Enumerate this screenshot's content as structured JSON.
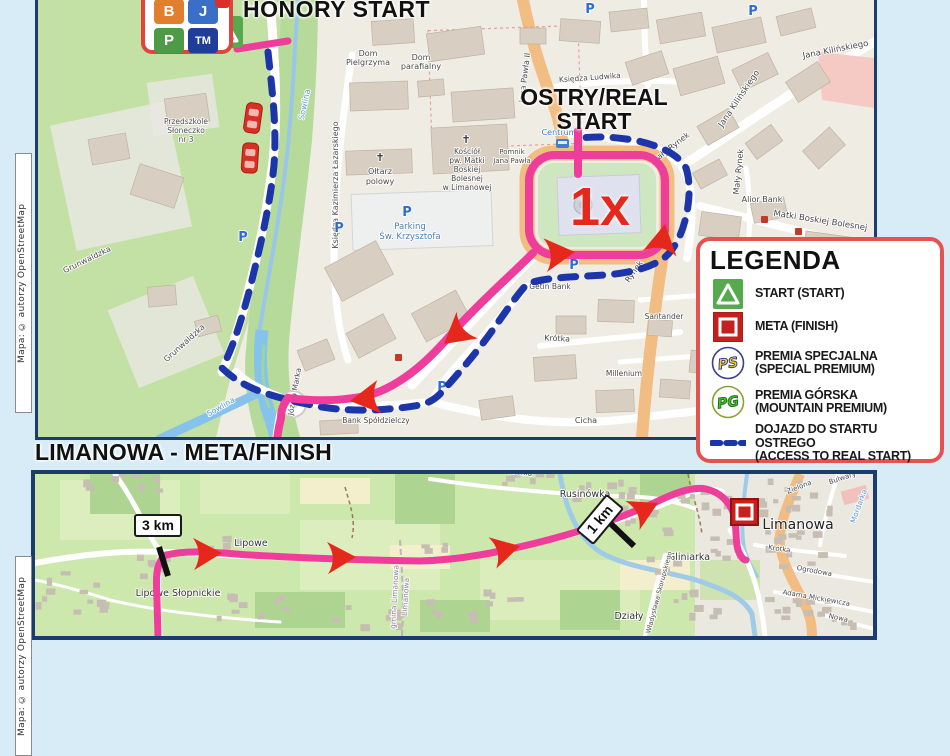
{
  "attribution": {
    "text": "Mapa: © autorzy OpenStreetMap"
  },
  "badge_box": {
    "tiles": [
      {
        "label": "B",
        "color": "#e0802f"
      },
      {
        "label": "J",
        "color": "#3a6fc8"
      },
      {
        "label": "P",
        "color": "#4e9a47"
      },
      {
        "label": "TM",
        "color": "#1f3d99"
      }
    ]
  },
  "top_map": {
    "honory_title": "HONORY START",
    "ostry_line1": "OSTRY/REAL",
    "ostry_line2": "START",
    "lap_label": "1x",
    "labels": [
      {
        "t": "Dom",
        "x": 368,
        "y": 56,
        "s": 8
      },
      {
        "t": "Pielgrzyma",
        "x": 368,
        "y": 65,
        "s": 8
      },
      {
        "t": "Dom",
        "x": 421,
        "y": 60,
        "s": 8
      },
      {
        "t": "parafialny",
        "x": 421,
        "y": 69,
        "s": 8
      },
      {
        "t": "✝",
        "x": 466,
        "y": 143,
        "s": 11,
        "c": "#333"
      },
      {
        "t": "Kościół",
        "x": 467,
        "y": 154,
        "s": 7.5
      },
      {
        "t": "pw. Matki",
        "x": 467,
        "y": 163,
        "s": 7.5
      },
      {
        "t": "Boskiej",
        "x": 467,
        "y": 172,
        "s": 7.5
      },
      {
        "t": "Bolesnej",
        "x": 467,
        "y": 181,
        "s": 7.5
      },
      {
        "t": "w Limanowej",
        "x": 467,
        "y": 190,
        "s": 7.5
      },
      {
        "t": "✝",
        "x": 380,
        "y": 161,
        "s": 11,
        "c": "#333"
      },
      {
        "t": "Ołtarz",
        "x": 380,
        "y": 174,
        "s": 8
      },
      {
        "t": "polowy",
        "x": 380,
        "y": 184,
        "s": 8
      },
      {
        "t": "P",
        "x": 407,
        "y": 216,
        "s": 13,
        "c": "#2e6ccf",
        "w": 700
      },
      {
        "t": "Parking",
        "x": 410,
        "y": 229,
        "s": 8.5,
        "c": "#4a7fb5"
      },
      {
        "t": "Św. Krzysztofa",
        "x": 410,
        "y": 239,
        "s": 8.5,
        "c": "#4a7fb5"
      },
      {
        "t": "Przedszkole",
        "x": 186,
        "y": 124,
        "s": 7.5
      },
      {
        "t": "Słoneczko",
        "x": 186,
        "y": 133,
        "s": 7.5
      },
      {
        "t": "nr 3",
        "x": 186,
        "y": 142,
        "s": 7.5
      },
      {
        "t": "Grunwaldzka",
        "x": 88,
        "y": 262,
        "s": 8,
        "r": -26
      },
      {
        "t": "Grunwaldzka",
        "x": 186,
        "y": 345,
        "s": 8,
        "r": -42
      },
      {
        "t": "Księdza Kazimierza Łazarskiego",
        "x": 338,
        "y": 185,
        "s": 8,
        "r": -90
      },
      {
        "t": "Jana Pawła II",
        "x": 527,
        "y": 78,
        "s": 8,
        "r": -83
      },
      {
        "t": "Księdza Ludwika",
        "x": 590,
        "y": 80,
        "s": 7.5,
        "r": -4
      },
      {
        "t": "Mały Rynek",
        "x": 672,
        "y": 150,
        "s": 8,
        "r": -38
      },
      {
        "t": "Mały Rynek",
        "x": 741,
        "y": 172,
        "s": 8,
        "r": -84
      },
      {
        "t": "Jana Kilińskiego",
        "x": 836,
        "y": 52,
        "s": 8.5,
        "r": -11
      },
      {
        "t": "Jana Kilińskiego",
        "x": 741,
        "y": 100,
        "s": 8.5,
        "r": -56
      },
      {
        "t": "Alior Bank",
        "x": 762,
        "y": 202,
        "s": 8
      },
      {
        "t": "Matki Boskiej Bolesnej",
        "x": 820,
        "y": 223,
        "s": 8.5,
        "r": 9
      },
      {
        "t": "Rynek",
        "x": 636,
        "y": 273,
        "s": 8,
        "r": -55
      },
      {
        "t": "Krótka",
        "x": 557,
        "y": 341,
        "s": 8,
        "r": 3
      },
      {
        "t": "Cicha",
        "x": 586,
        "y": 423,
        "s": 8
      },
      {
        "t": "Santander",
        "x": 664,
        "y": 319,
        "s": 7.5
      },
      {
        "t": "Millenium",
        "x": 624,
        "y": 376,
        "s": 7.5
      },
      {
        "t": "Getin Bank",
        "x": 550,
        "y": 289,
        "s": 7.5
      },
      {
        "t": "Bank Spółdzielczy",
        "x": 376,
        "y": 423,
        "s": 7.5
      },
      {
        "t": "Pomnik",
        "x": 512,
        "y": 154,
        "s": 7
      },
      {
        "t": "Jana Pawła",
        "x": 512,
        "y": 163,
        "s": 7
      },
      {
        "t": "Centrum",
        "x": 559,
        "y": 135,
        "s": 8,
        "c": "#3b79c9"
      },
      {
        "t": "Sowlina",
        "x": 307,
        "y": 105,
        "s": 8,
        "c": "#5a9bd0",
        "r": -78
      },
      {
        "t": "Sowlina",
        "x": 222,
        "y": 409,
        "s": 8,
        "c": "#5a9bd0",
        "r": -30
      },
      {
        "t": "Józefa Marka",
        "x": 297,
        "y": 392,
        "s": 7.5,
        "r": -80
      },
      {
        "t": "P",
        "x": 590,
        "y": 13,
        "s": 13,
        "c": "#2e6ccf",
        "w": 700
      },
      {
        "t": "P",
        "x": 753,
        "y": 15,
        "s": 13,
        "c": "#2e6ccf",
        "w": 700
      },
      {
        "t": "P",
        "x": 243,
        "y": 241,
        "s": 13,
        "c": "#2e6ccf",
        "w": 700
      },
      {
        "t": "P",
        "x": 339,
        "y": 232,
        "s": 13,
        "c": "#2e6ccf",
        "w": 700
      },
      {
        "t": "P",
        "x": 574,
        "y": 269,
        "s": 13,
        "c": "#2e6ccf",
        "w": 700
      },
      {
        "t": "P",
        "x": 442,
        "y": 391,
        "s": 13,
        "c": "#2e6ccf",
        "w": 700
      }
    ]
  },
  "legend": {
    "title": "LEGENDA",
    "items": [
      {
        "icon": "start-icon",
        "label1": "START (START)",
        "label2": ""
      },
      {
        "icon": "meta-icon",
        "label1": "META (FINISH)",
        "label2": ""
      },
      {
        "icon": "ps-icon",
        "badge": "PS",
        "label1": "PREMIA SPECJALNA",
        "label2": "(SPECIAL PREMIUM)"
      },
      {
        "icon": "pg-icon",
        "badge": "PG",
        "label1": "PREMIA GÓRSKA",
        "label2": "(MOUNTAIN PREMIUM)"
      },
      {
        "icon": "dash-icon",
        "label1": "DOJAZD DO STARTU OSTREGO",
        "label2": "(ACCESS TO REAL START)"
      }
    ]
  },
  "bottom_map": {
    "header": "LIMANOWA - META/FINISH",
    "km3": "3 km",
    "km1": "1 km",
    "labels": [
      {
        "t": "Rusinówka",
        "x": 585,
        "y": 497,
        "s": 9.5,
        "c": "#333"
      },
      {
        "t": "Lipowe",
        "x": 251,
        "y": 546,
        "s": 9.5,
        "c": "#333"
      },
      {
        "t": "Lipowe Słopnickie",
        "x": 178,
        "y": 596,
        "s": 9.5,
        "c": "#333"
      },
      {
        "t": "Gliniarka",
        "x": 689,
        "y": 560,
        "s": 9.5,
        "c": "#333"
      },
      {
        "t": "Działy",
        "x": 629,
        "y": 619,
        "s": 9.5,
        "c": "#333"
      },
      {
        "t": "Limanowa",
        "x": 798,
        "y": 529,
        "s": 14,
        "c": "#222"
      },
      {
        "t": "Jana Biedronia",
        "x": 505,
        "y": 473,
        "s": 7.5,
        "r": 6
      },
      {
        "t": "Krótka",
        "x": 779,
        "y": 551,
        "s": 7,
        "r": 8
      },
      {
        "t": "Ogrodowa",
        "x": 814,
        "y": 573,
        "s": 7,
        "r": 10
      },
      {
        "t": "Adama Mickiewicza",
        "x": 816,
        "y": 600,
        "s": 7,
        "r": 10
      },
      {
        "t": "Nowa",
        "x": 838,
        "y": 620,
        "s": 7,
        "r": 12
      },
      {
        "t": "Władysława Skorupskiego",
        "x": 661,
        "y": 593,
        "s": 6.5,
        "r": -75
      },
      {
        "t": "Zielona",
        "x": 800,
        "y": 489,
        "s": 7,
        "r": -22
      },
      {
        "t": "Bulwary",
        "x": 843,
        "y": 480,
        "s": 7,
        "r": -18
      },
      {
        "t": "Mordarka",
        "x": 861,
        "y": 507,
        "s": 7.5,
        "c": "#5a9bd0",
        "r": -70
      },
      {
        "t": "gmina Limanowa",
        "x": 397,
        "y": 597,
        "s": 7.5,
        "c": "#8a7f98",
        "r": -87
      },
      {
        "t": "Limanowa",
        "x": 408,
        "y": 597,
        "s": 7.5,
        "c": "#8a7f98",
        "r": -87
      }
    ]
  }
}
